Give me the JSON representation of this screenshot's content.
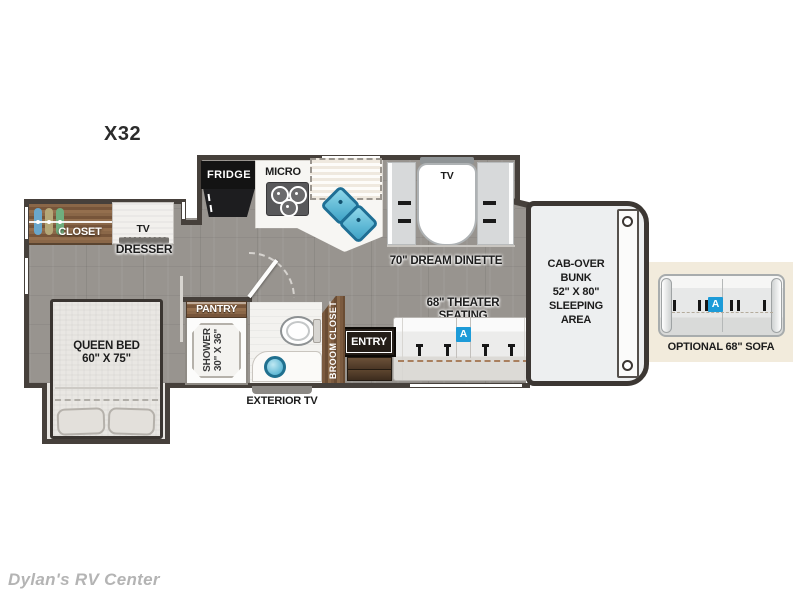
{
  "plan_title": "X32",
  "watermark": "Dylan's RV Center",
  "colors": {
    "accent_blue": "#1d9bd8",
    "wall": "#46403b",
    "wood": "#7d5d42",
    "floor": "#98948f",
    "inset_background": "#f2ebdc"
  },
  "labels": {
    "closet": "CLOSET",
    "dresser_tv": "TV",
    "dresser": "DRESSER",
    "queen_bed": "QUEEN BED\n60\" X 75\"",
    "fridge": "FRIDGE",
    "micro": "MICRO",
    "pantry": "PANTRY",
    "shower": "SHOWER\n30\" X 36\"",
    "broom_closet": "BROOM CLOSET",
    "entry": "ENTRY",
    "exterior_tv": "EXTERIOR TV",
    "dinette_tv": "TV",
    "dream_dinette": "70\" DREAM DINETTE",
    "theater_seating": "68\" THEATER SEATING",
    "cab_over_bunk": "CAB-OVER\nBUNK\n52\" X 80\"\nSLEEPING\nAREA",
    "seat_option_badge": "A",
    "optional_sofa": "OPTIONAL 68\" SOFA"
  }
}
